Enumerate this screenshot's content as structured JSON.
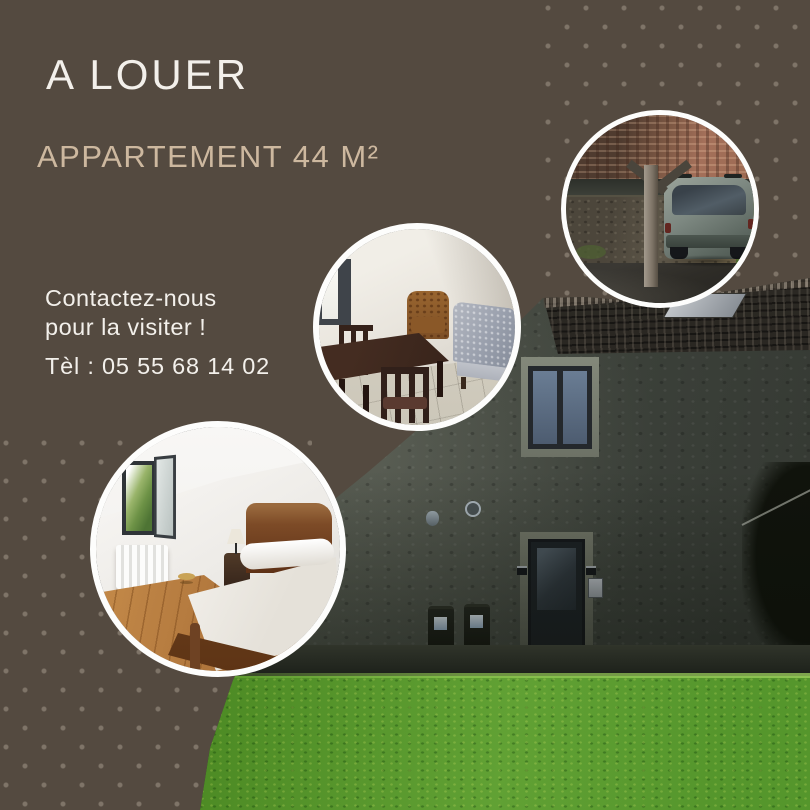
{
  "poster": {
    "title": "A LOUER",
    "subtitle": "APPARTEMENT 44 M²",
    "contact": {
      "line1": "Contactez-nous",
      "line2": "pour la visiter !",
      "phone": "Tèl : 05 55 68 14 02"
    },
    "colors": {
      "background": "#544a40",
      "dot_pattern": "#8a7c6c",
      "title_text": "#f3f0eb",
      "subtitle_text": "#cdb89f",
      "circle_border": "#fdfdfc",
      "grass": "#4f8d26",
      "stone_wall": "#4a4e46"
    },
    "photos": [
      {
        "name": "carport-with-car",
        "shape": "circle"
      },
      {
        "name": "dining-room",
        "shape": "circle"
      },
      {
        "name": "bedroom",
        "shape": "circle"
      },
      {
        "name": "house-exterior-with-lawn",
        "shape": "diagonal-background"
      }
    ]
  }
}
